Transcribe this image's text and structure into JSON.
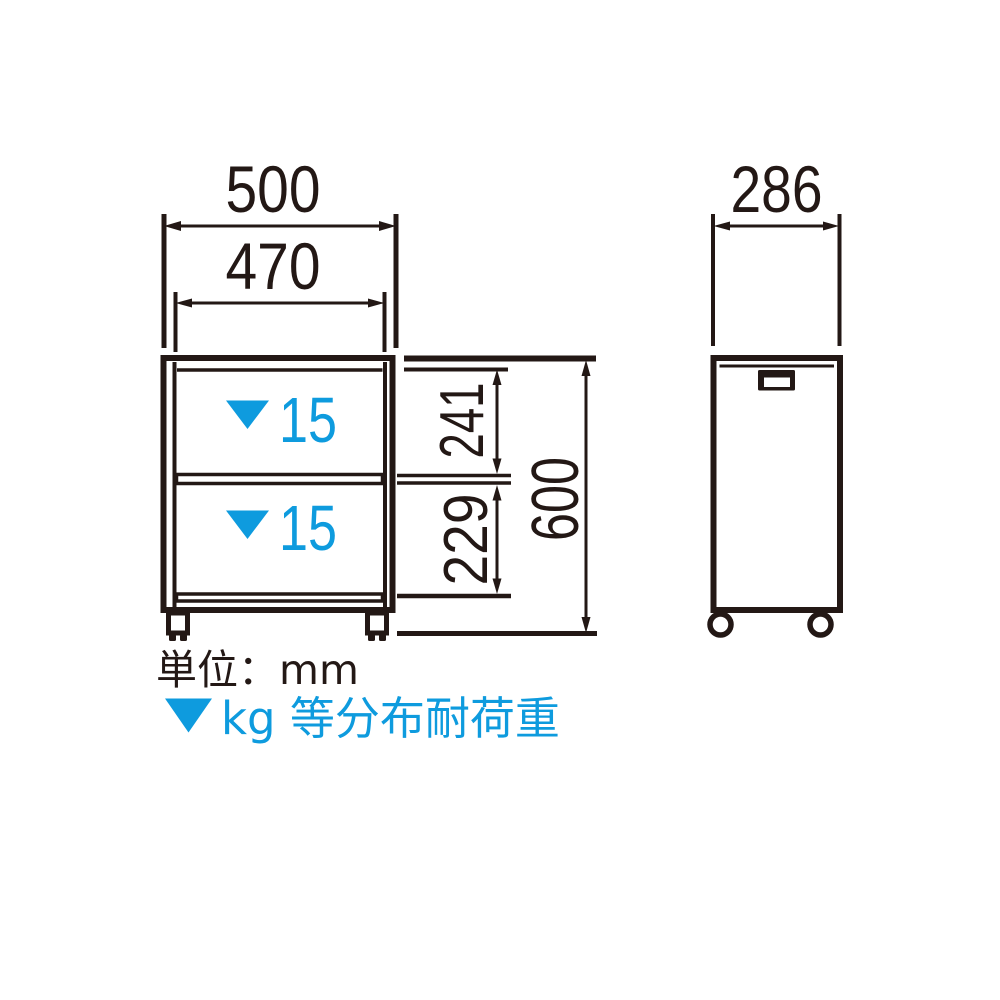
{
  "colors": {
    "line": "#231815",
    "accent_blue": "#0E9BDE",
    "background": "#FFFFFF"
  },
  "views": {
    "front": {
      "name": "front view of two-shelf caster cart",
      "dimensions": {
        "outer_width": "500",
        "inner_width": "470",
        "upper_compartment_height": "241",
        "lower_compartment_height": "229",
        "overall_height": "600"
      },
      "shelf_loads": {
        "upper": "15",
        "lower": "15"
      }
    },
    "side": {
      "name": "side view of cart",
      "dimensions": {
        "depth": "286"
      }
    }
  },
  "legend": {
    "unit_note": "単位：mm",
    "load_note": "kg 等分布耐荷重",
    "load_marker_icon": "filled-down-triangle"
  }
}
